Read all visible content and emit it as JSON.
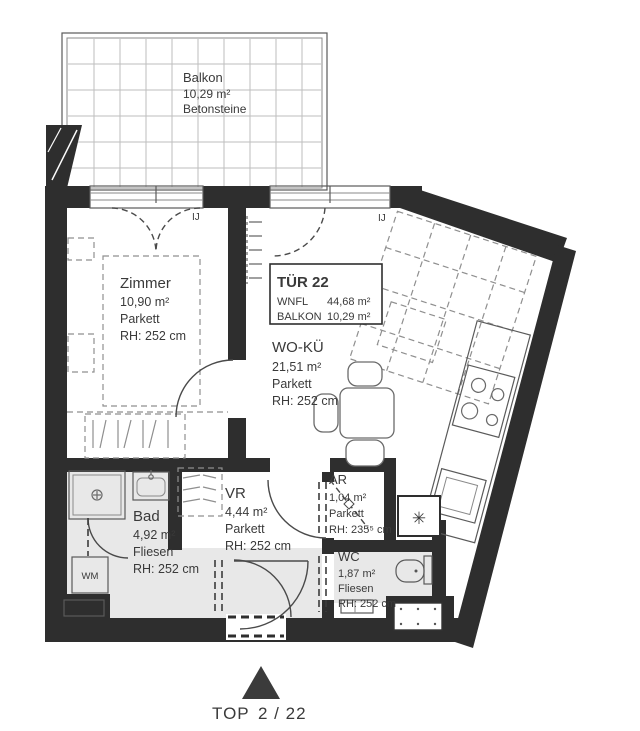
{
  "plan": {
    "rooms": [
      {
        "name": "Balkon",
        "area": "10,29 m²",
        "floor": "Betonsteine"
      },
      {
        "name": "Zimmer",
        "area": "10,90 m²",
        "floor": "Parkett",
        "height": "RH: 252 cm"
      },
      {
        "name": "WO-KÜ",
        "area": "21,51 m²",
        "floor": "Parkett",
        "height": "RH: 252 cm"
      },
      {
        "name": "Bad",
        "area": "4,92 m²",
        "floor": "Fliesen",
        "height": "RH: 252 cm"
      },
      {
        "name": "VR",
        "area": "4,44 m²",
        "floor": "Parkett",
        "height": "RH: 252 cm"
      },
      {
        "name": "AR",
        "area": "1,04 m²",
        "floor": "Parkett",
        "height": "RH: 235⁵ cm"
      },
      {
        "name": "WC",
        "area": "1,87 m²",
        "floor": "Fliesen",
        "height": "RH: 252 cm"
      }
    ],
    "unit_box": {
      "title": "TÜR 22",
      "rows": [
        {
          "label": "WNFL",
          "value": "44,68 m²"
        },
        {
          "label": "BALKON",
          "value": "10,29 m²"
        }
      ]
    },
    "marks": {
      "washing_machine": "WM",
      "window_mark_left": "IJ",
      "window_mark_right": "IJ",
      "heater": "✳"
    },
    "footer": {
      "label": "TOP",
      "value": "2 / 22"
    },
    "colors": {
      "wall": "#2e2e2e",
      "tile_floor": "#e8e8e8",
      "text": "#3a3a3a",
      "grid_line": "#bdbdbd",
      "dash_line": "#8f8f8f"
    }
  }
}
